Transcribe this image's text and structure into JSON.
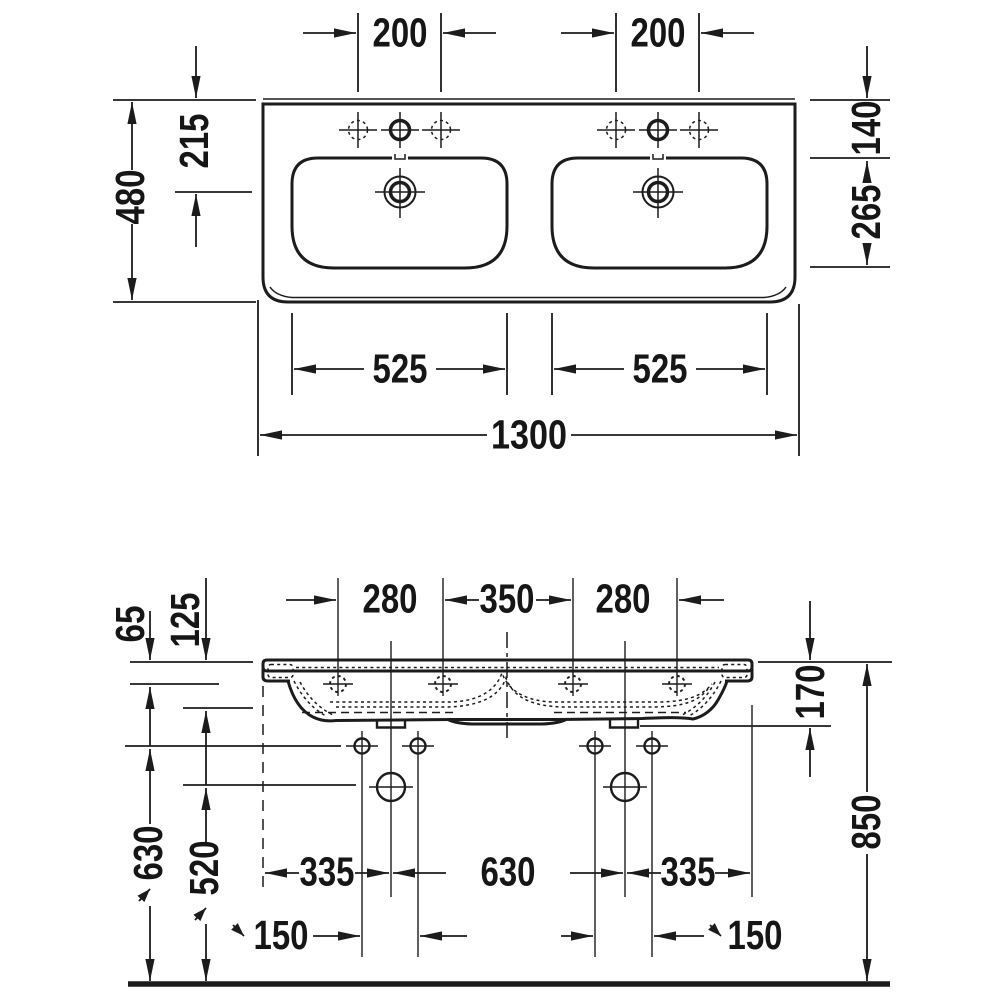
{
  "subject": "double-washbasin-technical-dimension-drawing",
  "units": "mm",
  "colors": {
    "line": "#1c1c1c",
    "background": "#ffffff"
  },
  "plan_view": {
    "dims": {
      "tap_hole_spacing_left": "200",
      "tap_hole_spacing_right": "200",
      "overall_depth": "480",
      "rear_to_drain": "215",
      "rear_to_bowl": "140",
      "bowl_depth": "265",
      "bowl_width_left": "525",
      "bowl_width_right": "525",
      "overall_width": "1300"
    }
  },
  "front_view": {
    "dims": {
      "tap_offset_left": "280",
      "tap_center_spacing": "350",
      "tap_offset_right": "280",
      "rim_to_tap_line": "65",
      "apron_height": "125",
      "ceramic_height": "170",
      "fixing_hole_height": "630",
      "drain_height": "520",
      "edge_to_trap_left": "335",
      "trap_spacing": "630",
      "edge_to_trap_right": "335",
      "fixing_hole_spacing_left": "150",
      "fixing_hole_spacing_right": "150",
      "installation_height": "850"
    }
  }
}
